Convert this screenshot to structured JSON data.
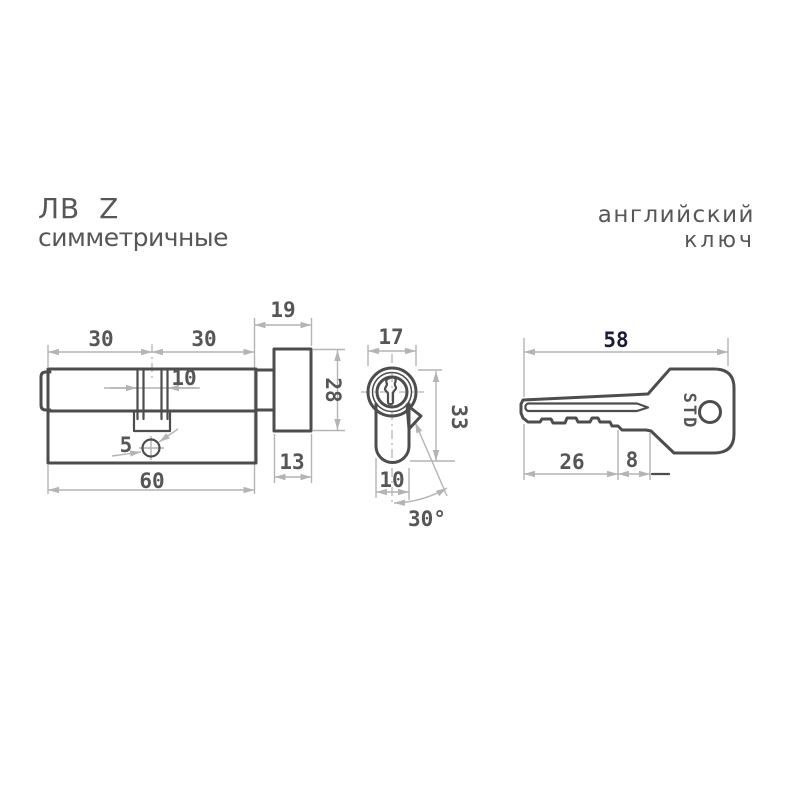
{
  "title_block": {
    "series": "ЛВ Z",
    "type": "симметричные"
  },
  "key_type": {
    "line1": "английский",
    "line2": "ключ"
  },
  "colors": {
    "outline": "#4d4d4d",
    "dimension_lines": "#b4b4b4",
    "labels": "#565656",
    "accent_label": "#1c1c38",
    "background": "#ffffff"
  },
  "side_view": {
    "label_left_half": "30",
    "label_right_half": "30",
    "label_knob_length": "19",
    "label_channel_width": "10",
    "label_screw_diameter": "5",
    "label_total_length": "60",
    "label_knob_width": "13",
    "label_knob_height": "28"
  },
  "front_view": {
    "label_face_width": "17",
    "label_height": "33",
    "label_body_width": "10",
    "label_cam_angle": "30°"
  },
  "key_view": {
    "label_total_length": "58",
    "label_blade_length": "26",
    "label_shoulder": "8",
    "brand": "STD"
  }
}
